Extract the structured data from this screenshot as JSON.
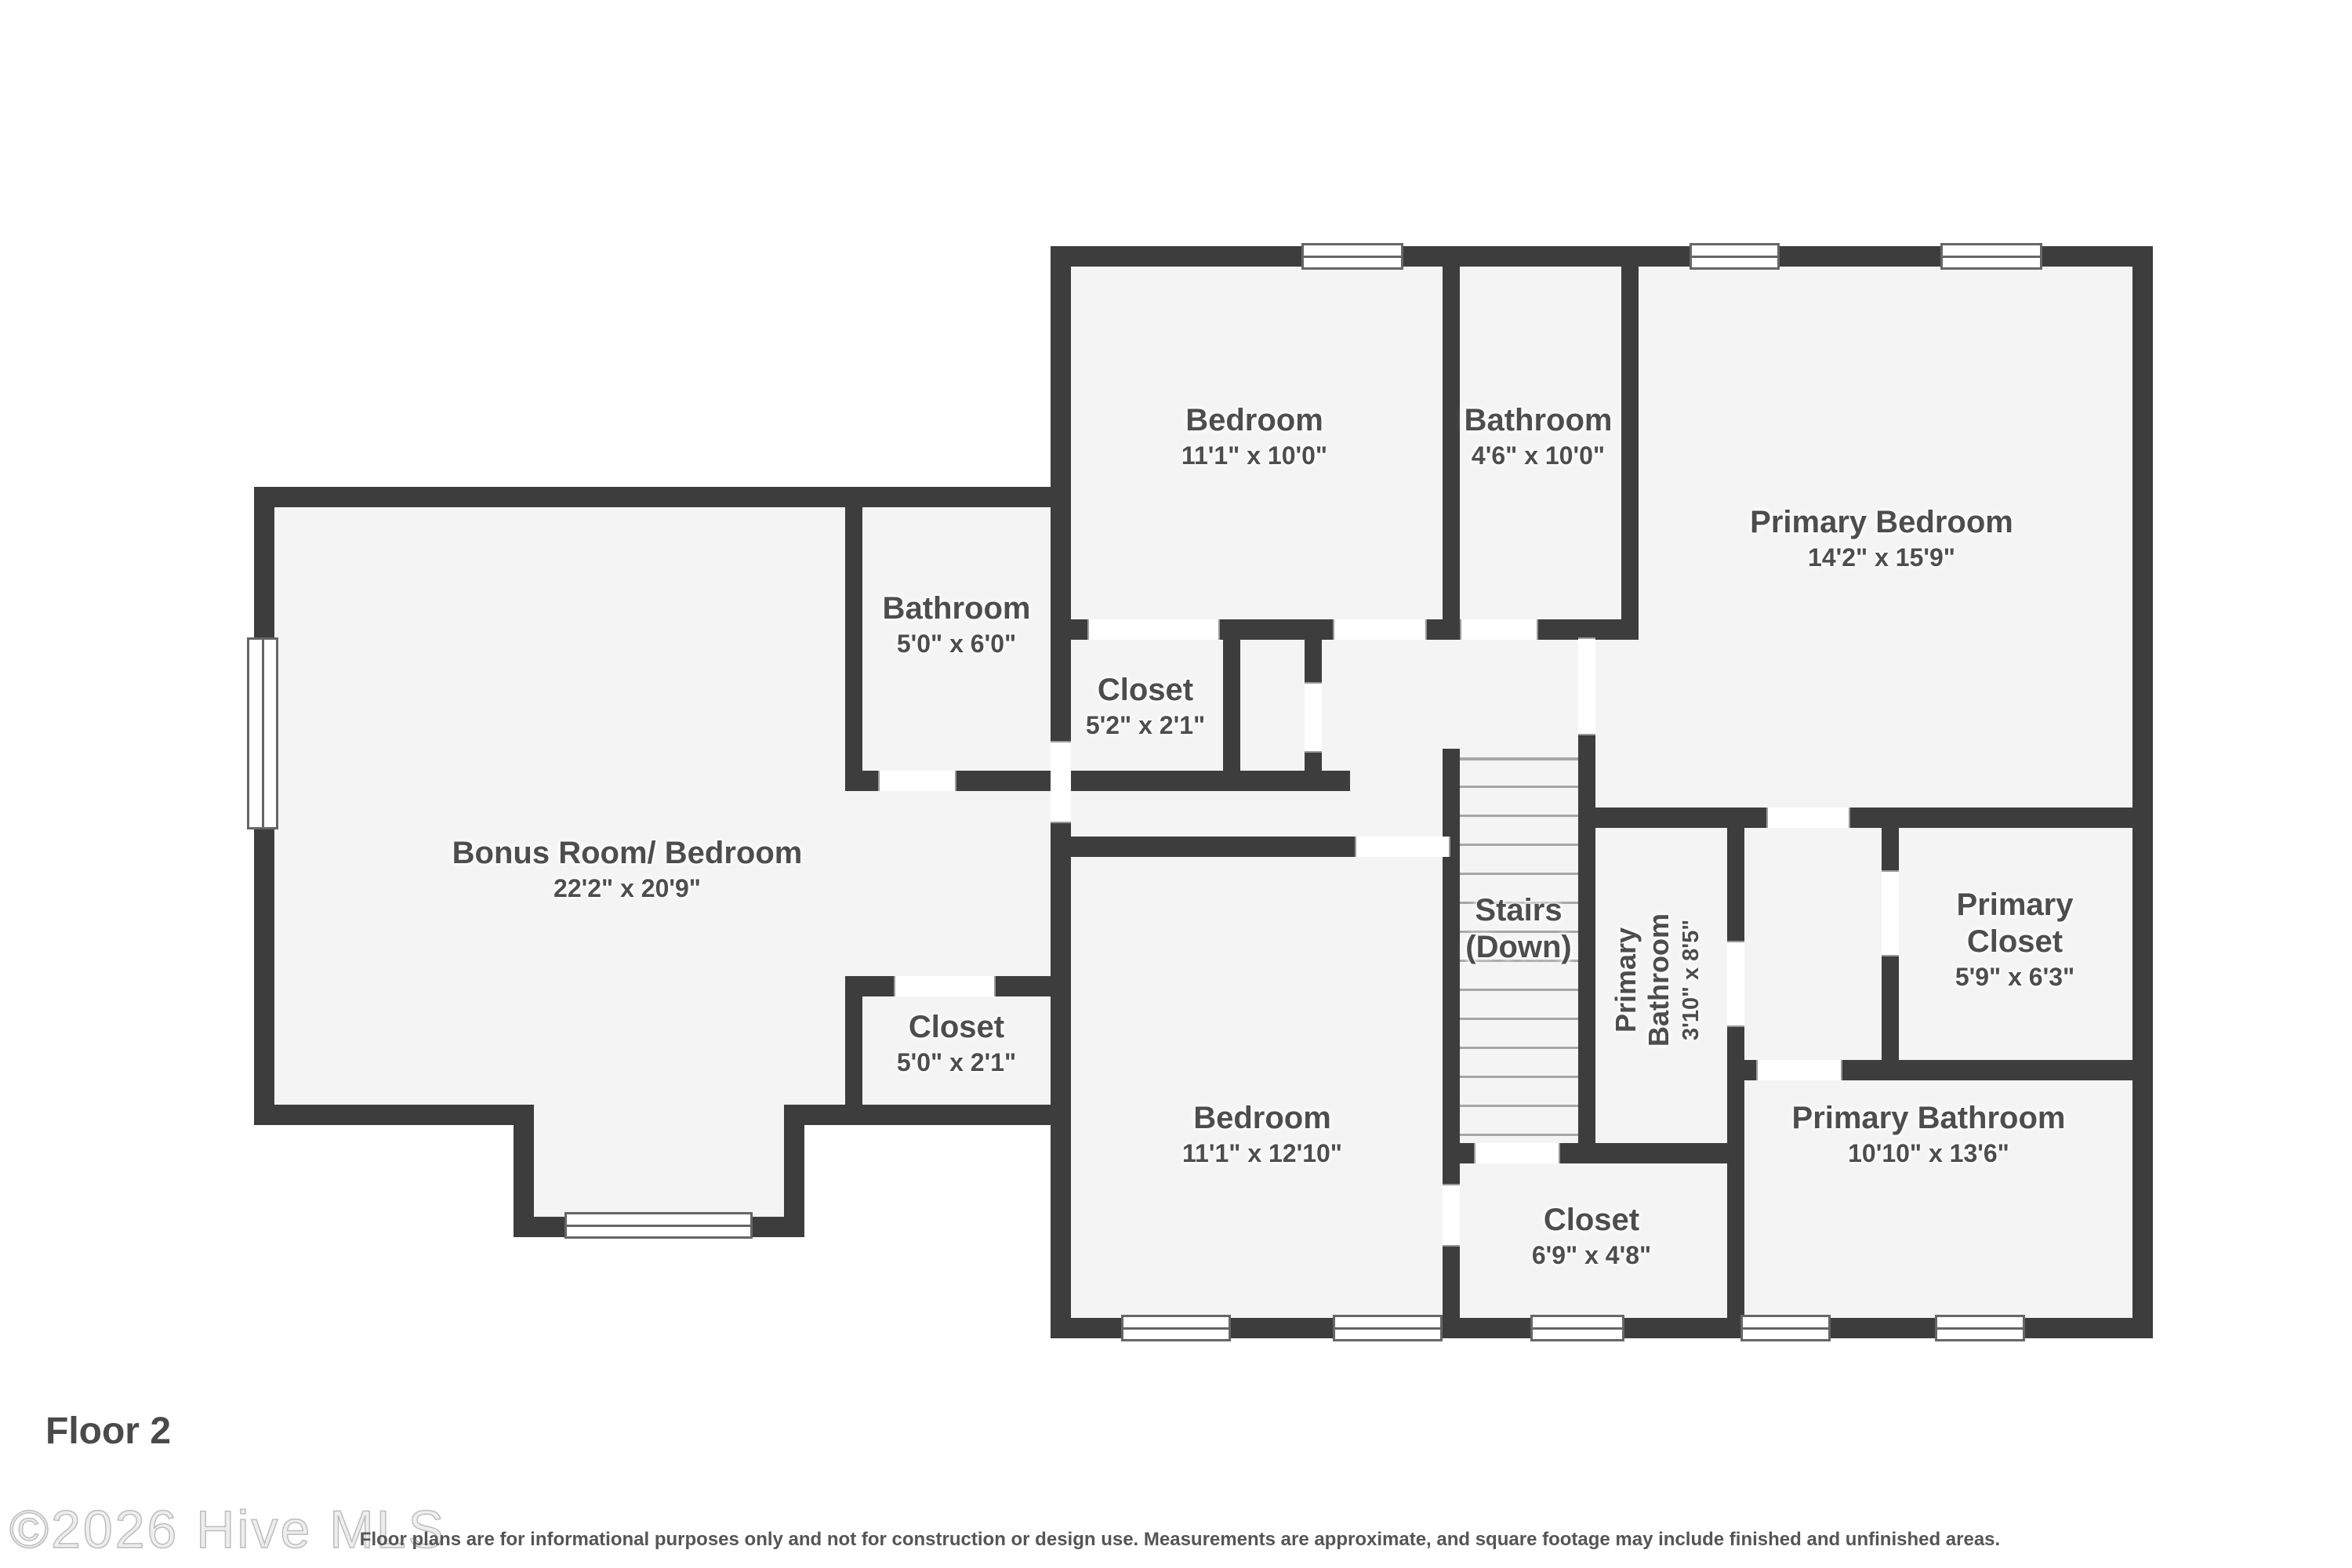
{
  "floor_label": "Floor 2",
  "watermark": "©2026 Hive MLS",
  "disclaimer": "Floor plans are for informational purposes only and not for construction or design use. Measurements are approximate, and square footage may include finished and unfinished areas.",
  "colors": {
    "wall": "#3d3d3d",
    "room_fill": "#f4f4f4",
    "label_text": "#4d4d4d",
    "stair_tread": "#a6a6a6",
    "watermark": "#bdbdbd",
    "disclaimer": "#555555"
  },
  "rooms": [
    {
      "id": "bonus-room",
      "name": "Bonus Room/ Bedroom",
      "dims": "22'2\" x 20'9\""
    },
    {
      "id": "bathroom-5x6",
      "name": "Bathroom",
      "dims": "5'0\" x 6'0\""
    },
    {
      "id": "closet-5x2",
      "name": "Closet",
      "dims": "5'2\" x 2'1\""
    },
    {
      "id": "bedroom-11x10",
      "name": "Bedroom",
      "dims": "11'1\" x 10'0\""
    },
    {
      "id": "bathroom-4x10",
      "name": "Bathroom",
      "dims": "4'6\" x 10'0\""
    },
    {
      "id": "primary-bedroom",
      "name": "Primary Bedroom",
      "dims": "14'2\" x 15'9\""
    },
    {
      "id": "stairs",
      "name": "Stairs\n(Down)",
      "dims": ""
    },
    {
      "id": "primary-bathroom-small",
      "name": "Primary\nBathroom",
      "dims": "3'10\" x 8'5\""
    },
    {
      "id": "primary-closet",
      "name": "Primary\nCloset",
      "dims": "5'9\" x 6'3\""
    },
    {
      "id": "bedroom-11x12",
      "name": "Bedroom",
      "dims": "11'1\" x 12'10\""
    },
    {
      "id": "closet-5x2-lower",
      "name": "Closet",
      "dims": "5'0\" x 2'1\""
    },
    {
      "id": "closet-6x4",
      "name": "Closet",
      "dims": "6'9\" x 4'8\""
    },
    {
      "id": "primary-bathroom-large",
      "name": "Primary Bathroom",
      "dims": "10'10\" x 13'6\""
    }
  ]
}
